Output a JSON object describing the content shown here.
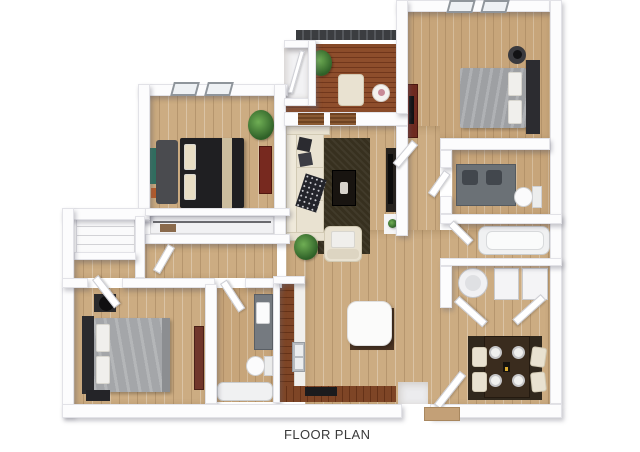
{
  "caption": {
    "label": "FLOOR PLAN"
  },
  "floor_plan": {
    "render_style": "3D top-down architectural rendering on white background",
    "rooms": [
      {
        "id": "bedroom-top-left",
        "windows": 2,
        "furniture": [
          "black-bed",
          "cream-pillows",
          "gray-bench",
          "red-desk",
          "wall-art",
          "palm-plant"
        ]
      },
      {
        "id": "balcony",
        "features": [
          "dark-railing",
          "red-wood-deck",
          "storage-closet",
          "shuttered-doors"
        ],
        "furniture": [
          "lounge-chair",
          "round-table",
          "potted-plants"
        ]
      },
      {
        "id": "master-bedroom",
        "windows": 2,
        "furniture": [
          "gray-bed",
          "dark-headboard",
          "round-nightstand",
          "black-lamp",
          "red-dresser"
        ]
      },
      {
        "id": "bathroom-right",
        "furniture": [
          "gray-double-vanity",
          "toilet"
        ]
      },
      {
        "id": "tub-room",
        "furniture": [
          "bathtub"
        ]
      },
      {
        "id": "laundry-closet",
        "furniture": [
          "washer",
          "dryer",
          "double-doors"
        ]
      },
      {
        "id": "living-room",
        "furniture": [
          "l-shaped-cream-sofa",
          "dark-area-rug",
          "coffee-table",
          "armchair",
          "tv-console",
          "plants"
        ]
      },
      {
        "id": "hallway",
        "furniture": [
          "linen-closet-with-shelves",
          "wardrobe-closet"
        ]
      },
      {
        "id": "bedroom-bottom-left",
        "furniture": [
          "gray-bed",
          "dark-headboard",
          "nightstand",
          "black-lamp",
          "red-mirror"
        ]
      },
      {
        "id": "bathroom-bottom",
        "furniture": [
          "gray-vanity",
          "toilet",
          "bathtub"
        ]
      },
      {
        "id": "kitchen",
        "furniture": [
          "l-shaped-cherry-cabinets",
          "white-counter",
          "double-sink",
          "cooktop"
        ]
      },
      {
        "id": "dining-area",
        "furniture": [
          "dark-dining-table",
          "four-cream-chairs",
          "four-place-settings",
          "candle",
          "white-square-table"
        ]
      },
      {
        "id": "entry",
        "furniture": [
          "open-door",
          "wood-landing"
        ]
      }
    ],
    "palette": {
      "background": "#ffffff",
      "walls": "#fcfcfd",
      "wood_floor": "#ccac82",
      "deck": "#8e4e2c",
      "cabinets": "#7e4526",
      "rug": "#37301f",
      "sofa": "#e9e2d1",
      "dark_furniture": "#1f1f22",
      "gray_bed": "#9ea0a3",
      "vanity": "#6b7176",
      "plant": "#3f7a3a",
      "accent_red": "#77291f"
    }
  }
}
